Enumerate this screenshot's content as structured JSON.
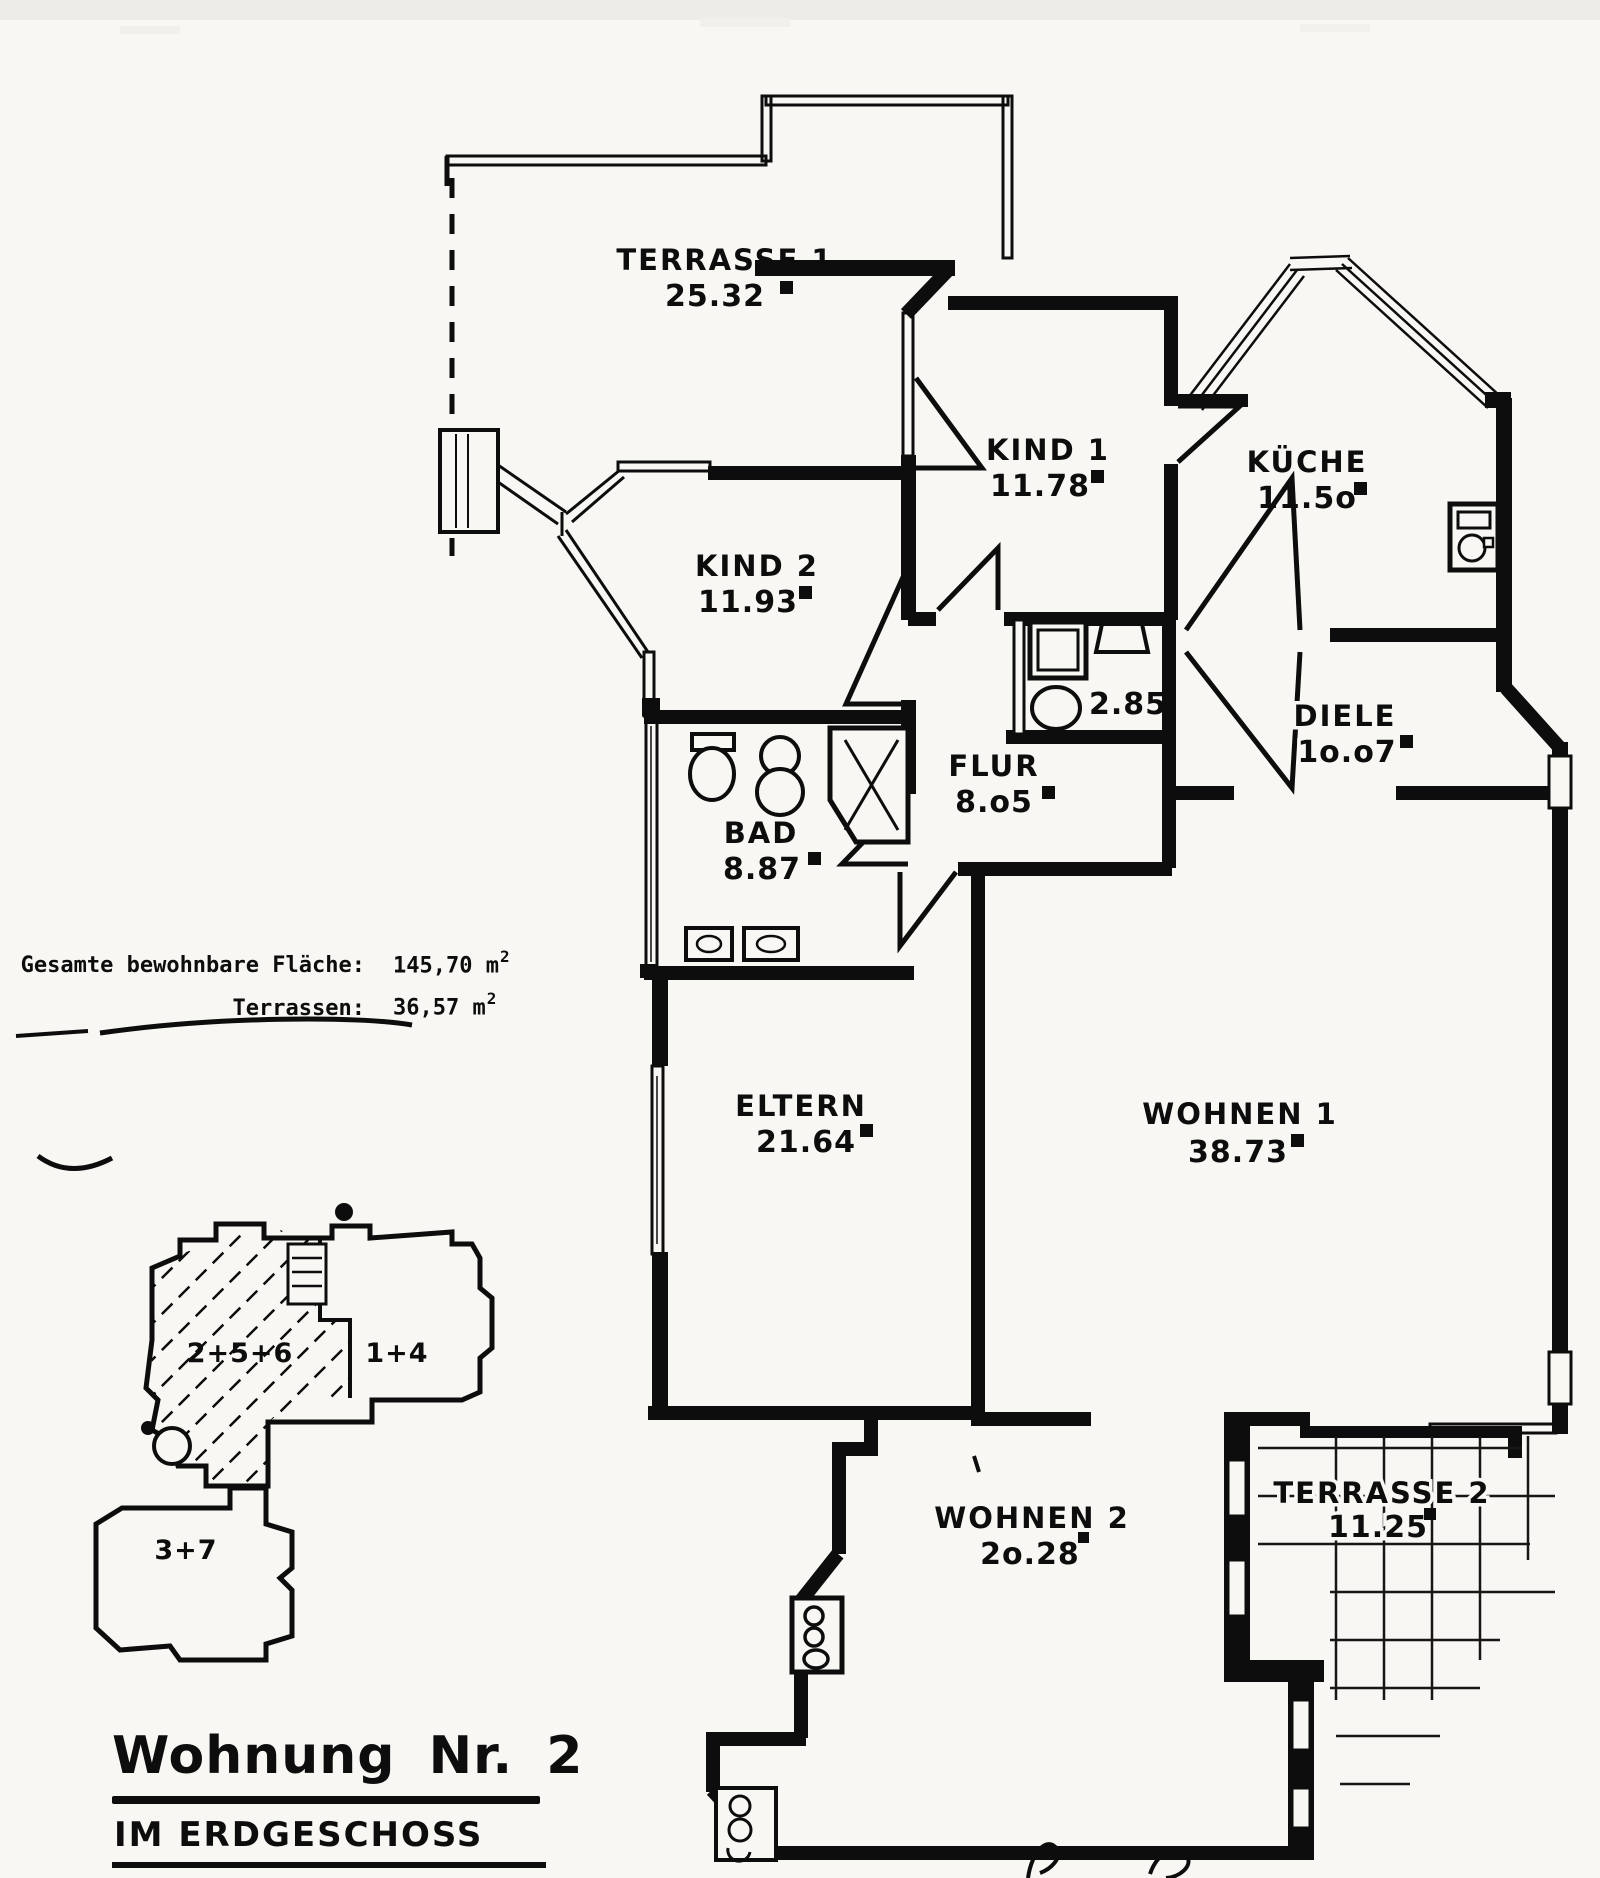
{
  "document_title": "Wohnung Nr. 2",
  "document_subtitle": "IM ERDGESCHOSS",
  "summary": {
    "rows": [
      {
        "label": "Gesamte bewohnbare Fläche:",
        "value": "145,70 m",
        "sup": "2"
      },
      {
        "label": "Terrassen:",
        "value": "36,57 m",
        "sup": "2"
      }
    ]
  },
  "rooms": {
    "terrasse1": {
      "name": "TERRASSE 1",
      "area": "25.32"
    },
    "kind1": {
      "name": "KIND 1",
      "area": "11.78"
    },
    "kueche": {
      "name": "KÜCHE",
      "area": "11.5o"
    },
    "kind2": {
      "name": "KIND 2",
      "area": "11.93"
    },
    "wc": {
      "name": "",
      "area": "2.85"
    },
    "diele": {
      "name": "DIELE",
      "area": "1o.o7"
    },
    "flur": {
      "name": "FLUR",
      "area": "8.o5"
    },
    "bad": {
      "name": "BAD",
      "area": "8.87"
    },
    "eltern": {
      "name": "ELTERN",
      "area": "21.64"
    },
    "wohnen1": {
      "name": "WOHNEN 1",
      "area": "38.73"
    },
    "wohnen2": {
      "name": "WOHNEN 2",
      "area": "2o.28"
    },
    "terrasse2": {
      "name": "TERRASSE 2",
      "area": "11.25"
    }
  },
  "keyplan": {
    "unit_hatched": "2+5+6",
    "unit_right": "1+4",
    "unit_lower": "3+7"
  },
  "ink_color": "#0d0d0d",
  "paper_color": "#f8f7f4"
}
